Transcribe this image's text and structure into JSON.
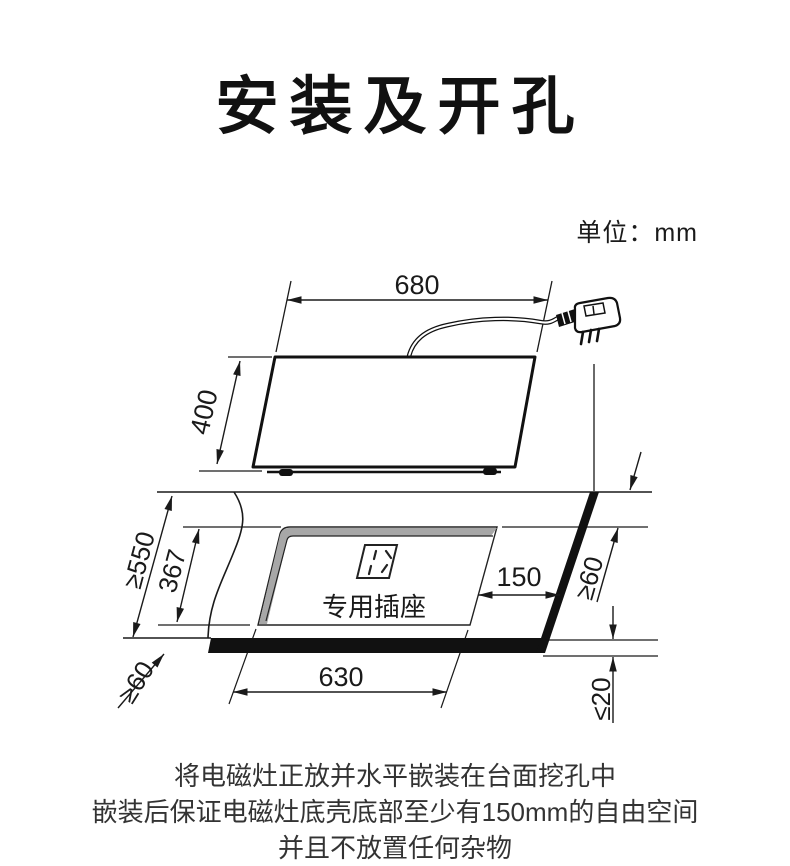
{
  "title": "安装及开孔",
  "unit_label": "单位：mm",
  "diagram": {
    "socket_label": "专用插座",
    "dims": {
      "cooktop_width": "680",
      "cooktop_depth": "400",
      "counter_min_depth": "≥550",
      "cutout_depth": "367",
      "cutout_width": "630",
      "socket_offset": "150",
      "left_front_clearance": "≥60",
      "right_clearance": "≥60",
      "edge_max_thickness": "≤20"
    },
    "colors": {
      "line": "#1a1a1a",
      "shadow_gray": "#a7a7a7"
    }
  },
  "caption": {
    "line1": "将电磁灶正放并水平嵌装在台面挖孔中",
    "line2": "嵌装后保证电磁灶底壳底部至少有150mm的自由空间",
    "line3": "并且不放置任何杂物"
  }
}
